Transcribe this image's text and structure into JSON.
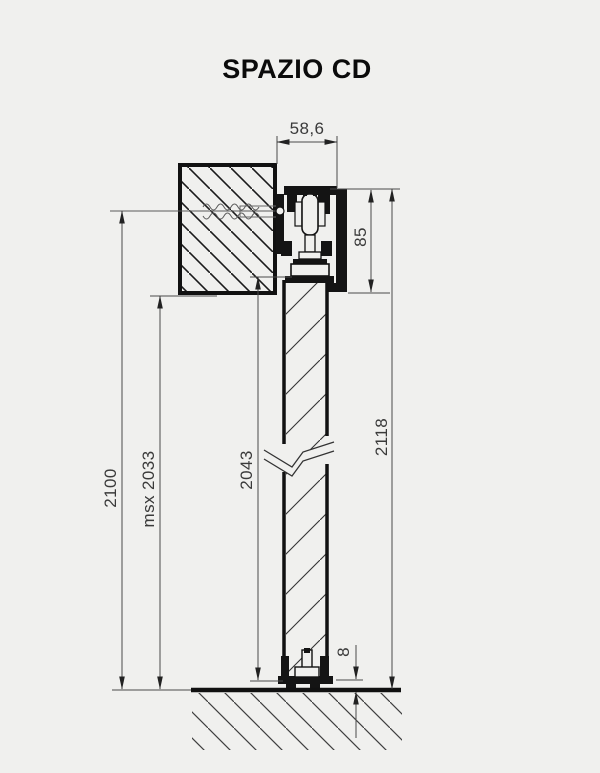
{
  "title": "SPAZIO CD",
  "dimensions": {
    "track_width": "58,6",
    "header_height": "85",
    "total_height": "2118",
    "door_height": "2043",
    "max_height": "msx 2033",
    "opening_height": "2100",
    "floor_gap": "8"
  },
  "colors": {
    "background": "#f0f0ee",
    "line": "#111111",
    "dimension_line": "#4a4a4a",
    "text": "#3a3a3a"
  }
}
